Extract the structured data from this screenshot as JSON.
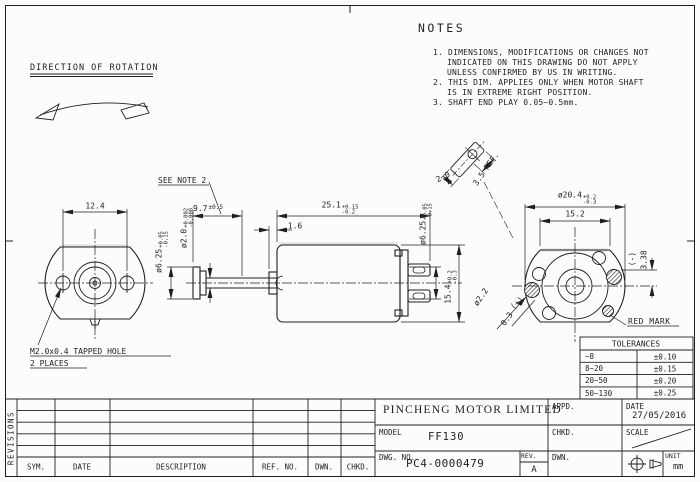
{
  "colors": {
    "paper": "#fcfcfa",
    "ink": "#1f1f1f"
  },
  "direction": {
    "label": "DIRECTION OF ROTATION"
  },
  "notes": {
    "title": "NOTES",
    "l1": "1. DIMENSIONS, MODIFICATIONS OR CHANGES NOT",
    "l2": "INDICATED ON THIS DRAWING DO NOT APPLY",
    "l3": "UNLESS CONFIRMED BY US IN WRITING.",
    "l4": "2. THIS DIM. APPLIES ONLY WHEN MOTOR SHAFT",
    "l5": "IS IN EXTREME RIGHT POSITION.",
    "l6": "3. SHAFT END PLAY 0.05~0.5mm."
  },
  "dims": {
    "see_note": "SEE NOTE 2",
    "hole_spacing": "12.4",
    "tapped1": "M2.0x0.4 TAPPED HOLE",
    "tapped2": "2 PLACES",
    "shaft_ext": {
      "v": "9.7",
      "tol": "±0.5"
    },
    "body_len": {
      "v": "25.1",
      "up": "+0.15",
      "dn": "-0.2"
    },
    "washer": "1.6",
    "boss_front": {
      "v": "ø6.25",
      "up": "+0.05",
      "dn": "-0.15"
    },
    "shaft_dia": {
      "v": "ø2.0",
      "up": "+0.002",
      "dn": "-0.008"
    },
    "boss_rear": {
      "v": "ø6.25",
      "up": "+0.05",
      "dn": "-0.15"
    },
    "body_height": {
      "v": "15.4",
      "up": "+0.2",
      "dn": "-0.3"
    },
    "can_dia": {
      "v": "ø20.4",
      "up": "+0.2",
      "dn": "-0.3"
    },
    "flat_width": "15.2",
    "neg": "(-)",
    "pos": "(+)",
    "terminal_offset": "3.38",
    "terminal_hole": "ø2.2",
    "terminal_thk": "0.3",
    "red_mark": "RED MARK",
    "det_width": "2.0",
    "det_len": "3.5 REF."
  },
  "tolerances": {
    "title": "TOLERANCES",
    "rows": [
      {
        "range": "~8",
        "tol": "±0.10"
      },
      {
        "range": "8~20",
        "tol": "±0.15"
      },
      {
        "range": "20~50",
        "tol": "±0.20"
      },
      {
        "range": "50~130",
        "tol": "±0.25"
      }
    ]
  },
  "title_block": {
    "company": "PINCHENG MOTOR LIMITED",
    "model_label": "MODEL",
    "model": "FF130",
    "dwg_label": "DWG. NO.",
    "dwg_no": "PC4-0000479",
    "rev_label": "REV.",
    "rev": "A",
    "appd_label": "APPD.",
    "chkd_label": "CHKD.",
    "dwn_label": "DWN.",
    "date_label": "DATE",
    "date": "27/05/2016",
    "scale_label": "SCALE",
    "unit_label": "UNIT",
    "unit": "mm"
  },
  "revisions": {
    "side_label": "REVISIONS",
    "headers": [
      "SYM.",
      "DATE",
      "DESCRIPTION",
      "REF. NO.",
      "DWN.",
      "CHKD."
    ]
  }
}
